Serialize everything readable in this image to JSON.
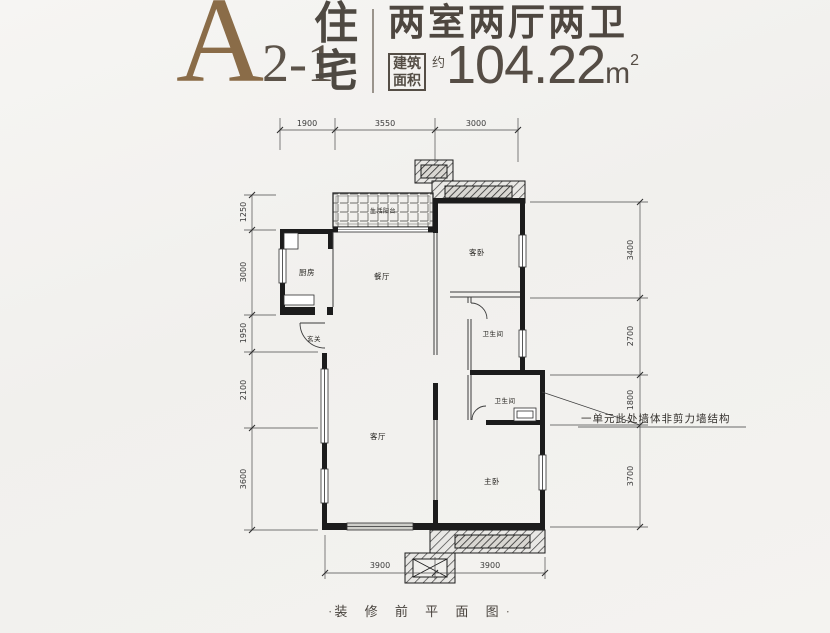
{
  "header": {
    "block_letter": "A",
    "unit_label": "2-1",
    "residence_char_top": "住",
    "residence_char_bottom": "宅",
    "layout_type": "两室两厅两卫",
    "area_box_line1": "建筑",
    "area_box_line2": "面积",
    "approx_char": "约",
    "area_value": "104.22",
    "area_unit": "m",
    "area_exponent": "2"
  },
  "floorplan": {
    "rooms": {
      "balcony": "生活阳台",
      "kitchen": "厨房",
      "dining": "餐厅",
      "foyer": "玄关",
      "guest_bedroom": "客卧",
      "bathroom_upper": "卫生间",
      "bathroom_lower": "卫生间",
      "living": "客厅",
      "master_bedroom": "主卧"
    },
    "dimensions": {
      "top": [
        "1900",
        "3550",
        "3000"
      ],
      "left": [
        "1250",
        "3000",
        "1950",
        "2100",
        "3600"
      ],
      "right": [
        "3400",
        "2700",
        "1800",
        "3700"
      ],
      "bottom": [
        "3900",
        "3900"
      ]
    },
    "annotation": "一单元此处墙体非剪力墙结构",
    "caption_dot": "·",
    "caption": "装 修 前 平 面 图"
  },
  "colors": {
    "accent_brown": "#8a6c48",
    "ink": "#524b43",
    "wall": "#1c1c1c"
  }
}
